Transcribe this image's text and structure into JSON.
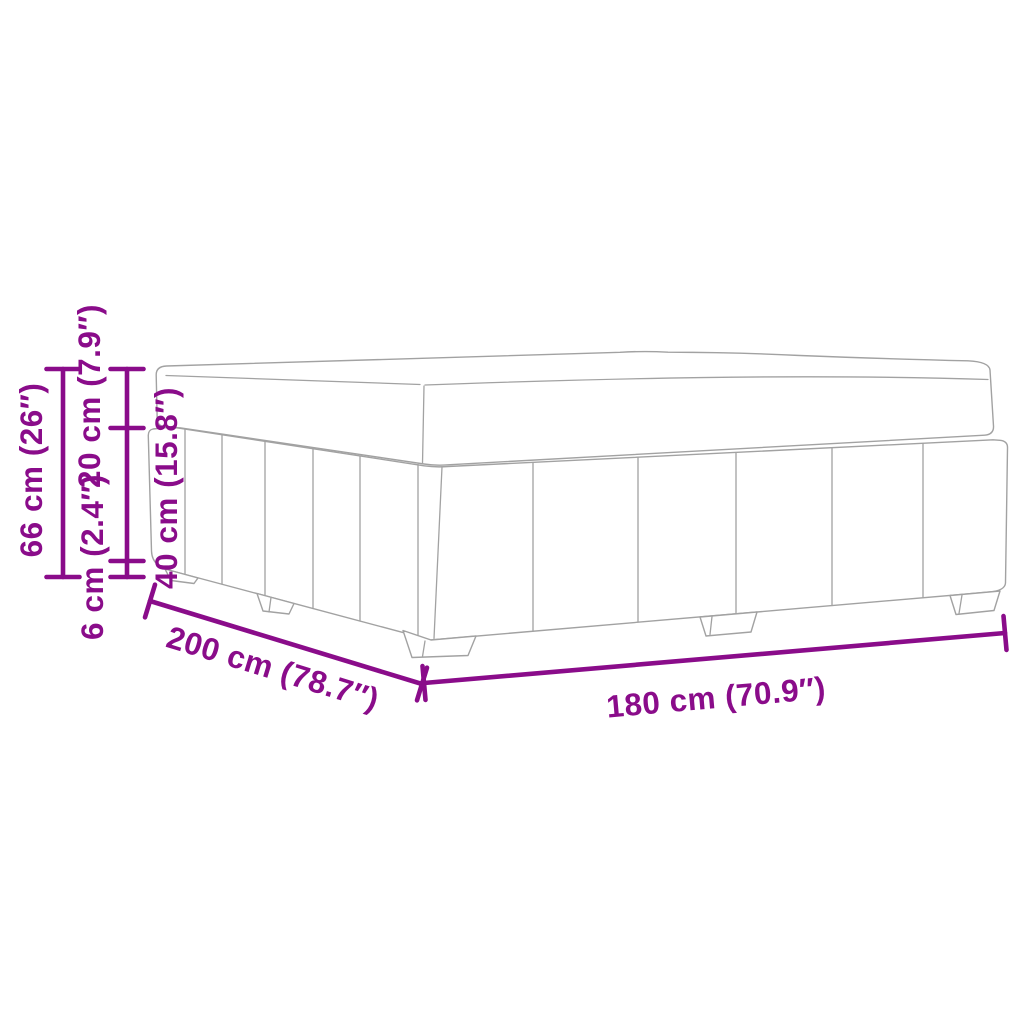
{
  "diagram": {
    "dimensions": {
      "total_height": "66 cm (26″)",
      "mattress_height": "20 cm (7.9″)",
      "base_height": "40 cm (15.8″)",
      "feet_height": "6 cm (2.4″)",
      "length": "200 cm (78.7″)",
      "width": "180 cm (70.9″)"
    },
    "colors": {
      "dimension_accent": "#8a0c8a",
      "sketch_outline": "#a2a2a2",
      "background": "#ffffff"
    }
  }
}
